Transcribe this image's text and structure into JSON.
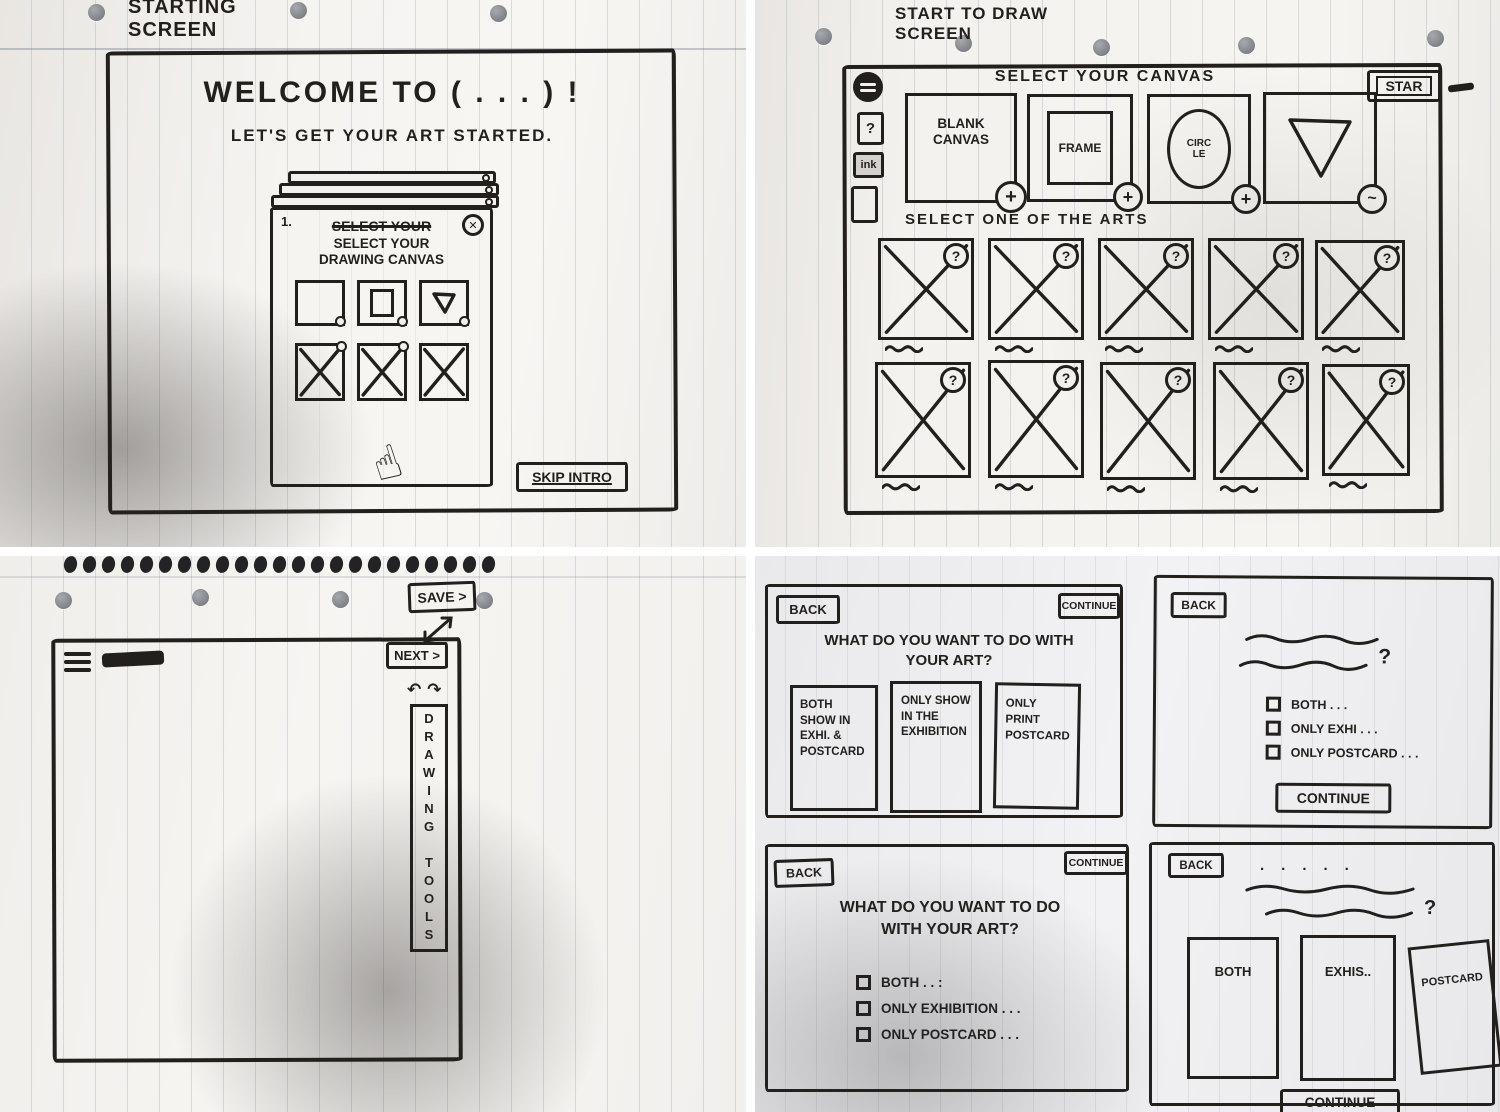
{
  "colors": {
    "ink": "#221f1c",
    "paper": "#f3f1ed",
    "gutter": "#ffffff"
  },
  "icons": {
    "close": "✕",
    "plus": "+",
    "question": "?",
    "undo": "↶",
    "redo": "↷",
    "pointer": "☝",
    "tilde": "~"
  },
  "starting_screen": {
    "annotation": "STARTING SCREEN",
    "title": "WELCOME TO ( . . . ) !",
    "subtitle": "LET'S GET YOUR ART STARTED.",
    "modal_step": "1.",
    "modal_crossed_out": "SELECT YOUR",
    "modal_title": "SELECT YOUR DRAWING CANVAS",
    "skip_button": "SKIP INTRO"
  },
  "start_to_draw": {
    "annotation": "START TO DRAW SCREEN",
    "header": "SELECT YOUR CANVAS",
    "start_button": "STAR",
    "help_icon": "?",
    "ink_icon": "ink",
    "canvas_options": [
      {
        "label": "BLANK CANVAS",
        "badge": "+"
      },
      {
        "label": "FRAME",
        "badge": "+"
      },
      {
        "label": "CIRC LE",
        "badge": "+"
      },
      {
        "label": "",
        "badge": "~"
      }
    ],
    "arts_title": "SELECT ONE OF THE ARTS",
    "art_badge": "?"
  },
  "drawing_screen": {
    "save_button": "SAVE >",
    "next_button": "NEXT >",
    "tools_label": "DRAWING TOOLS",
    "undo_icon": "↶",
    "redo_icon": "↷"
  },
  "art_destination": {
    "screen_a": {
      "back": "BACK",
      "continue": "CONTINUE",
      "question": "WHAT DO YOU WANT TO DO WITH YOUR ART?",
      "cards": [
        "BOTH SHOW IN EXHI. & POSTCARD",
        "ONLY SHOW IN THE EXHIBITION",
        "ONLY PRINT POSTCARD"
      ]
    },
    "screen_b": {
      "back": "BACK",
      "question_mark": "?",
      "options": [
        "BOTH . . .",
        "ONLY EXHI . . .",
        "ONLY POSTCARD . . ."
      ],
      "continue": "CONTINUE"
    },
    "screen_c": {
      "back": "BACK",
      "continue": "CONTINUE",
      "question": "WHAT DO YOU WANT TO DO WITH YOUR ART?",
      "options": [
        "BOTH . . :",
        "ONLY EXHIBITION . . .",
        "ONLY POSTCARD . . ."
      ]
    },
    "screen_d": {
      "back": "BACK",
      "dots": "· · · · ·",
      "question_mark": "?",
      "cards": [
        "BOTH",
        "EXHIS..",
        "POSTCARD"
      ],
      "continue": "CONTINUE"
    }
  }
}
